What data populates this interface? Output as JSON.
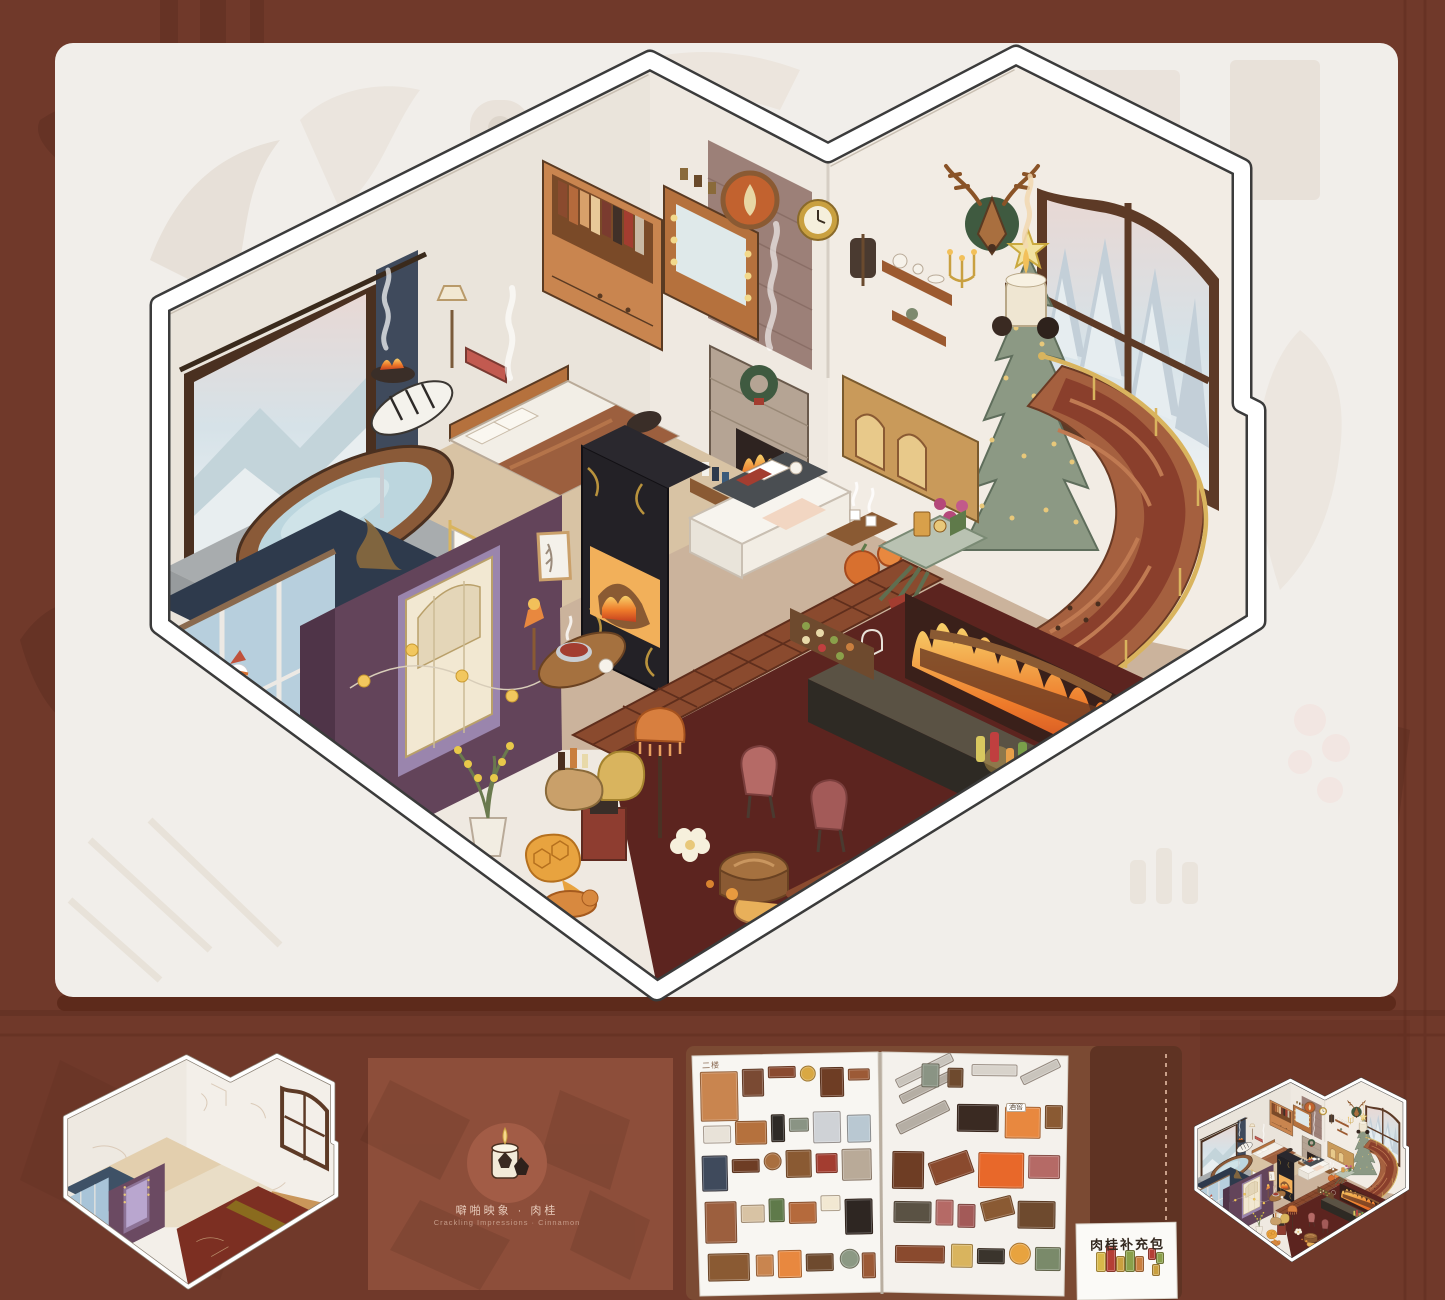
{
  "palette": {
    "background": "#70392a",
    "panel": "#f1eeea",
    "panel_shadow": "#5d2a1b",
    "scent_card_bg": "#8d4e3a",
    "scent_emblem_circle": "#a25c46",
    "book_cover": "#7b4a33",
    "page": "#f8f6f2",
    "cellar_floor": "#5c241f",
    "stairs": "#a5603f",
    "tree": "#8c9984",
    "gold_rail": "#d9b45e"
  },
  "scent_card": {
    "line_zh": "噼啪映象 · 肉桂",
    "line_en": "Crackling Impressions · Cinnamon",
    "emblem": "candle-with-pinecones-icon"
  },
  "refill_card": {
    "label": "肉桂补充包"
  },
  "sticker_book": {
    "left_sheet_label": "二楼",
    "right_sheet_label": "酒窖",
    "left_items": [
      [
        4,
        8,
        36,
        48,
        "#c9854f",
        "r",
        0
      ],
      [
        46,
        6,
        20,
        26,
        "#7a4a33",
        "r",
        0
      ],
      [
        72,
        4,
        26,
        10,
        "#8a4a30",
        "r",
        0
      ],
      [
        104,
        4,
        14,
        14,
        "#d9a843",
        "c",
        0
      ],
      [
        124,
        6,
        22,
        28,
        "#6e3d24",
        "r",
        0
      ],
      [
        152,
        8,
        20,
        10,
        "#9c5a36",
        "r",
        0
      ],
      [
        6,
        62,
        26,
        16,
        "#e8e2d8",
        "r",
        0
      ],
      [
        38,
        58,
        30,
        22,
        "#b5713d",
        "r",
        0
      ],
      [
        74,
        52,
        12,
        26,
        "#2e2a26",
        "r",
        0
      ],
      [
        92,
        56,
        18,
        12,
        "#8a9484",
        "r",
        0
      ],
      [
        116,
        50,
        26,
        30,
        "#cfd2d6",
        "r",
        0
      ],
      [
        150,
        54,
        22,
        26,
        "#b9c8d2",
        "r",
        0
      ],
      [
        4,
        92,
        24,
        34,
        "#3f4a5c",
        "r",
        0
      ],
      [
        34,
        96,
        26,
        12,
        "#6e3d24",
        "r",
        0
      ],
      [
        66,
        90,
        16,
        16,
        "#a96f3f",
        "c",
        0
      ],
      [
        88,
        88,
        24,
        26,
        "#8a5a33",
        "r",
        0
      ],
      [
        118,
        92,
        20,
        18,
        "#a33d30",
        "r",
        0
      ],
      [
        144,
        88,
        28,
        30,
        "#b9aa98",
        "r",
        0
      ],
      [
        6,
        138,
        30,
        40,
        "#9c5f3e",
        "r",
        0
      ],
      [
        42,
        142,
        22,
        16,
        "#d8c3a4",
        "r",
        0
      ],
      [
        70,
        136,
        14,
        22,
        "#5f7a4a",
        "r",
        0
      ],
      [
        90,
        140,
        26,
        20,
        "#b56a3c",
        "r",
        0
      ],
      [
        122,
        134,
        18,
        14,
        "#f2e8d2",
        "r",
        0
      ],
      [
        146,
        138,
        26,
        34,
        "#2e2622",
        "r",
        0
      ],
      [
        8,
        190,
        40,
        26,
        "#8a5a33",
        "r",
        0
      ],
      [
        56,
        192,
        16,
        20,
        "#c9854f",
        "r",
        0
      ],
      [
        78,
        188,
        22,
        26,
        "#e8883f",
        "r",
        0
      ],
      [
        106,
        192,
        26,
        16,
        "#6e4a2e",
        "r",
        0
      ],
      [
        140,
        188,
        18,
        18,
        "#8c9984",
        "c",
        0
      ],
      [
        162,
        192,
        12,
        24,
        "#9c5a36",
        "r",
        0
      ]
    ],
    "right_items": [
      [
        6,
        6,
        60,
        8,
        "#c9c4bc",
        "r",
        -27
      ],
      [
        10,
        22,
        60,
        8,
        "#b5aea4",
        "r",
        -27
      ],
      [
        34,
        4,
        16,
        22,
        "#8a9484",
        "r",
        0
      ],
      [
        60,
        8,
        14,
        18,
        "#6e4a2e",
        "r",
        0
      ],
      [
        84,
        4,
        44,
        10,
        "#d8d3cb",
        "r",
        0
      ],
      [
        132,
        6,
        40,
        8,
        "#c9c4bc",
        "r",
        -27
      ],
      [
        8,
        52,
        54,
        10,
        "#b5aea4",
        "r",
        -27
      ],
      [
        70,
        44,
        40,
        26,
        "#3a2a22",
        "r",
        0
      ],
      [
        118,
        46,
        34,
        30,
        "#e8883f",
        "r",
        0
      ],
      [
        158,
        44,
        16,
        22,
        "#8a5a33",
        "r",
        0
      ],
      [
        6,
        92,
        30,
        36,
        "#6e3d24",
        "r",
        0
      ],
      [
        44,
        96,
        40,
        22,
        "#8a4a2e",
        "r",
        -20
      ],
      [
        92,
        92,
        44,
        34,
        "#e8682a",
        "r",
        0
      ],
      [
        142,
        94,
        30,
        22,
        "#b56a66",
        "r",
        0
      ],
      [
        8,
        142,
        36,
        20,
        "#5a5244",
        "r",
        0
      ],
      [
        50,
        140,
        16,
        24,
        "#b56a66",
        "r",
        0
      ],
      [
        72,
        144,
        16,
        22,
        "#a35a58",
        "r",
        0
      ],
      [
        96,
        138,
        30,
        18,
        "#8a5a33",
        "r",
        -15
      ],
      [
        132,
        140,
        36,
        26,
        "#6e4a2e",
        "r",
        0
      ],
      [
        10,
        186,
        48,
        16,
        "#8a4a2e",
        "r",
        0
      ],
      [
        66,
        184,
        20,
        22,
        "#d9b45e",
        "r",
        0
      ],
      [
        92,
        188,
        26,
        14,
        "#3a342c",
        "r",
        0
      ],
      [
        124,
        182,
        20,
        20,
        "#e8a33f",
        "c",
        0
      ],
      [
        150,
        186,
        24,
        22,
        "#7a8a6a",
        "r",
        0
      ]
    ],
    "refill_items": [
      [
        14,
        26,
        8,
        18,
        "#d8b84a",
        "r",
        0
      ],
      [
        24,
        20,
        8,
        24,
        "#b53f35",
        "r",
        0
      ],
      [
        34,
        30,
        7,
        14,
        "#caa03f",
        "r",
        0
      ],
      [
        43,
        24,
        8,
        20,
        "#8aa04a",
        "r",
        0
      ],
      [
        53,
        30,
        7,
        14,
        "#c97f3f",
        "r",
        0
      ],
      [
        66,
        22,
        6,
        10,
        "#b53f35",
        "r",
        0
      ],
      [
        74,
        26,
        6,
        10,
        "#8aa04a",
        "r",
        0
      ],
      [
        70,
        38,
        6,
        10,
        "#caa03f",
        "r",
        0
      ]
    ]
  }
}
